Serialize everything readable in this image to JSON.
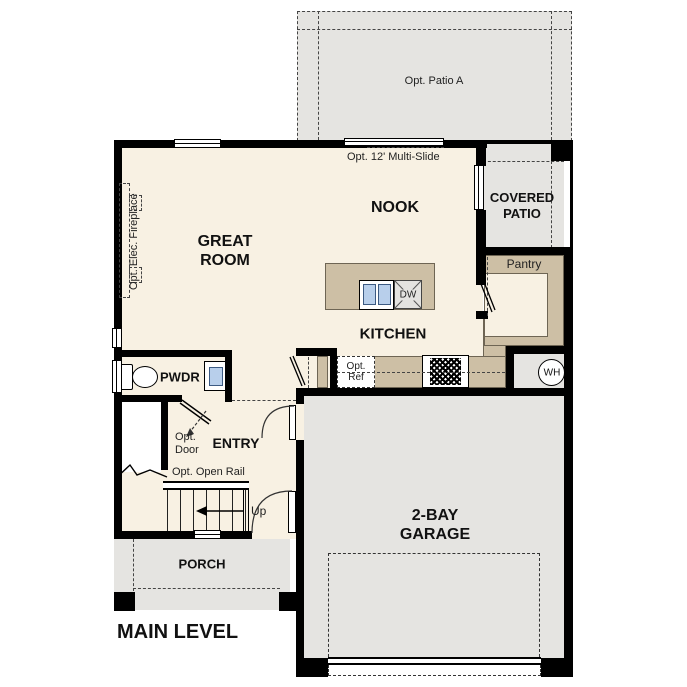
{
  "title": "MAIN LEVEL",
  "rooms": {
    "great_room_l1": "GREAT",
    "great_room_l2": "ROOM",
    "nook": "NOOK",
    "kitchen": "KITCHEN",
    "entry": "ENTRY",
    "pwdr": "PWDR",
    "pantry": "Pantry",
    "porch": "PORCH",
    "covered_patio_l1": "COVERED",
    "covered_patio_l2": "PATIO",
    "garage_l1": "2-BAY",
    "garage_l2": "GARAGE"
  },
  "annotations": {
    "opt_patio": "Opt. Patio A",
    "multi_slide": "Opt. 12' Multi-Slide",
    "fireplace": "Opt. Elec. Fireplace",
    "opt_ref_l1": "Opt.",
    "opt_ref_l2": "Ref",
    "opt_door_l1": "Opt.",
    "opt_door_l2": "Door",
    "opt_open_rail": "Opt. Open Rail",
    "up": "Up"
  },
  "fixtures": {
    "dw": "DW",
    "wh": "WH"
  },
  "colors": {
    "wall": "#000000",
    "floor": "#f8f1e3",
    "exterior": "#e5e4e1",
    "counter": "#cdbfa5",
    "sink_blue": "#b8cfeb",
    "appliance": "#e4e3e0"
  }
}
